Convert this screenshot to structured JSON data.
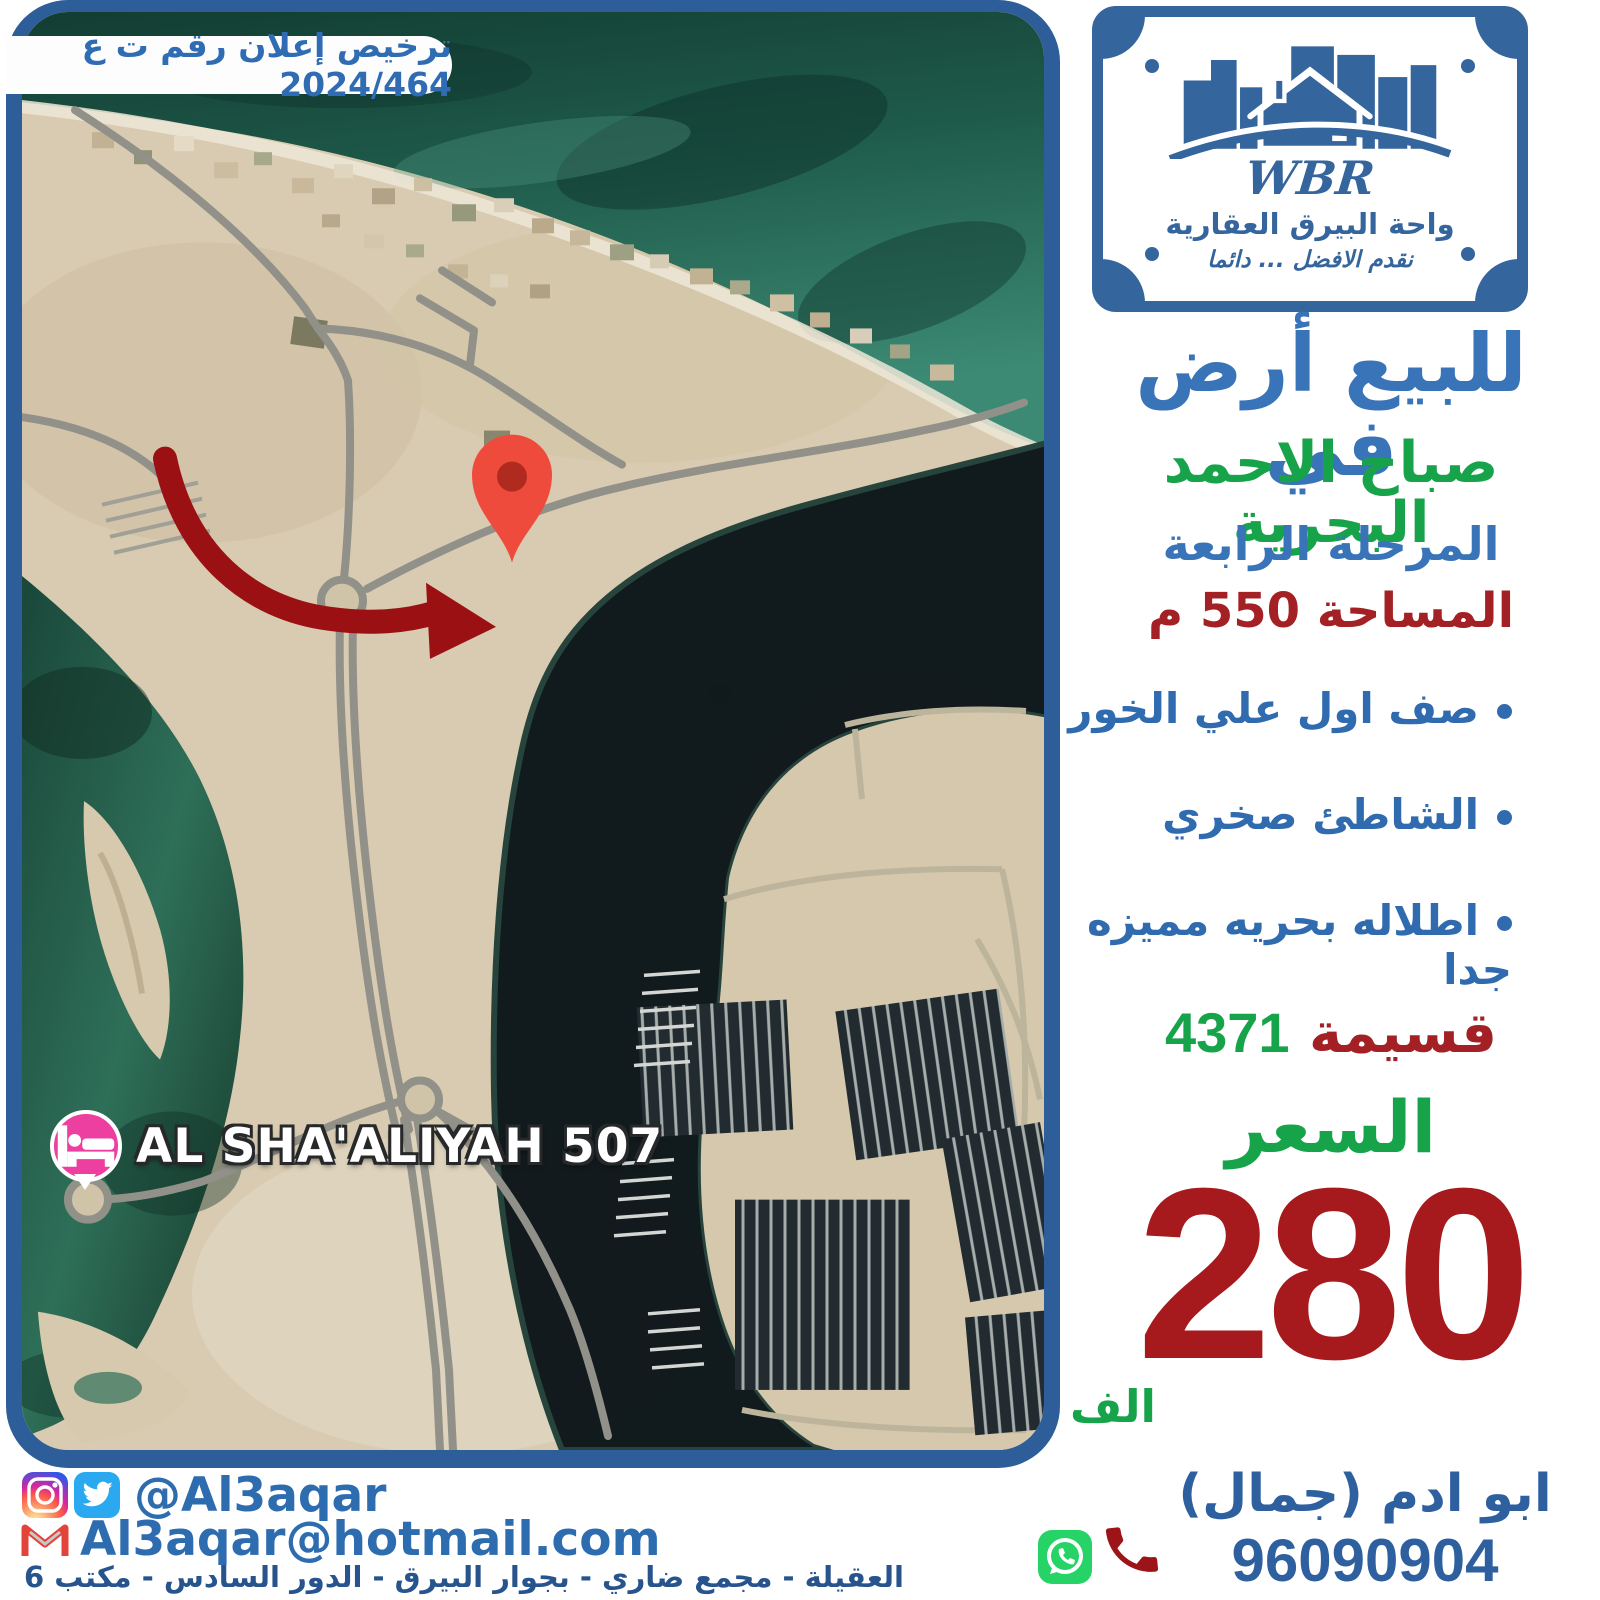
{
  "license_badge": "ترخيص إعلان رقم ت ع 2024/464",
  "logo": {
    "abbr": "WBR",
    "company": "واحة البيرق العقارية",
    "tagline": "نقدم الافضل ... دائما"
  },
  "listing": {
    "title": "للبيع أرض في",
    "location": "صباح الاحمد البحرية",
    "phase": "المرحلة الرابعة",
    "area": "المساحة 550 م",
    "features": [
      "صف اول علي الخور",
      "الشاطئ صخري",
      "اطلاله بحريه مميزه جدا"
    ],
    "plot_label": "قسيمة",
    "plot_number": "4371",
    "price_label": "السعر",
    "price_value": "280",
    "price_unit": "الف"
  },
  "map_overlay": {
    "place_label": "AL SHA'ALIYAH 507"
  },
  "contact": {
    "agent": "ابو ادم (جمال)",
    "phone": "96090904",
    "handle": "@Al3aqar",
    "email": "Al3aqar@hotmail.com",
    "address": "العقيلة - مجمع ضاري - بجوار البيرق - الدور السادس - مكتب 6"
  },
  "colors": {
    "frame_blue": "#2e5e99",
    "logo_blue": "#35659d",
    "title_blue": "#3a74b8",
    "feature_blue": "#2f6bae",
    "green": "#17a34a",
    "dark_red": "#a32024",
    "price_red": "#a6191c",
    "arrow_red": "#9b1113",
    "pin_red": "#ee4b3d",
    "whatsapp_green": "#25d366",
    "twitter_blue": "#2aa9f0",
    "instagram_pink": "#d6249f",
    "gmail_red": "#e3443a",
    "place_pink": "#ec3fa0"
  }
}
